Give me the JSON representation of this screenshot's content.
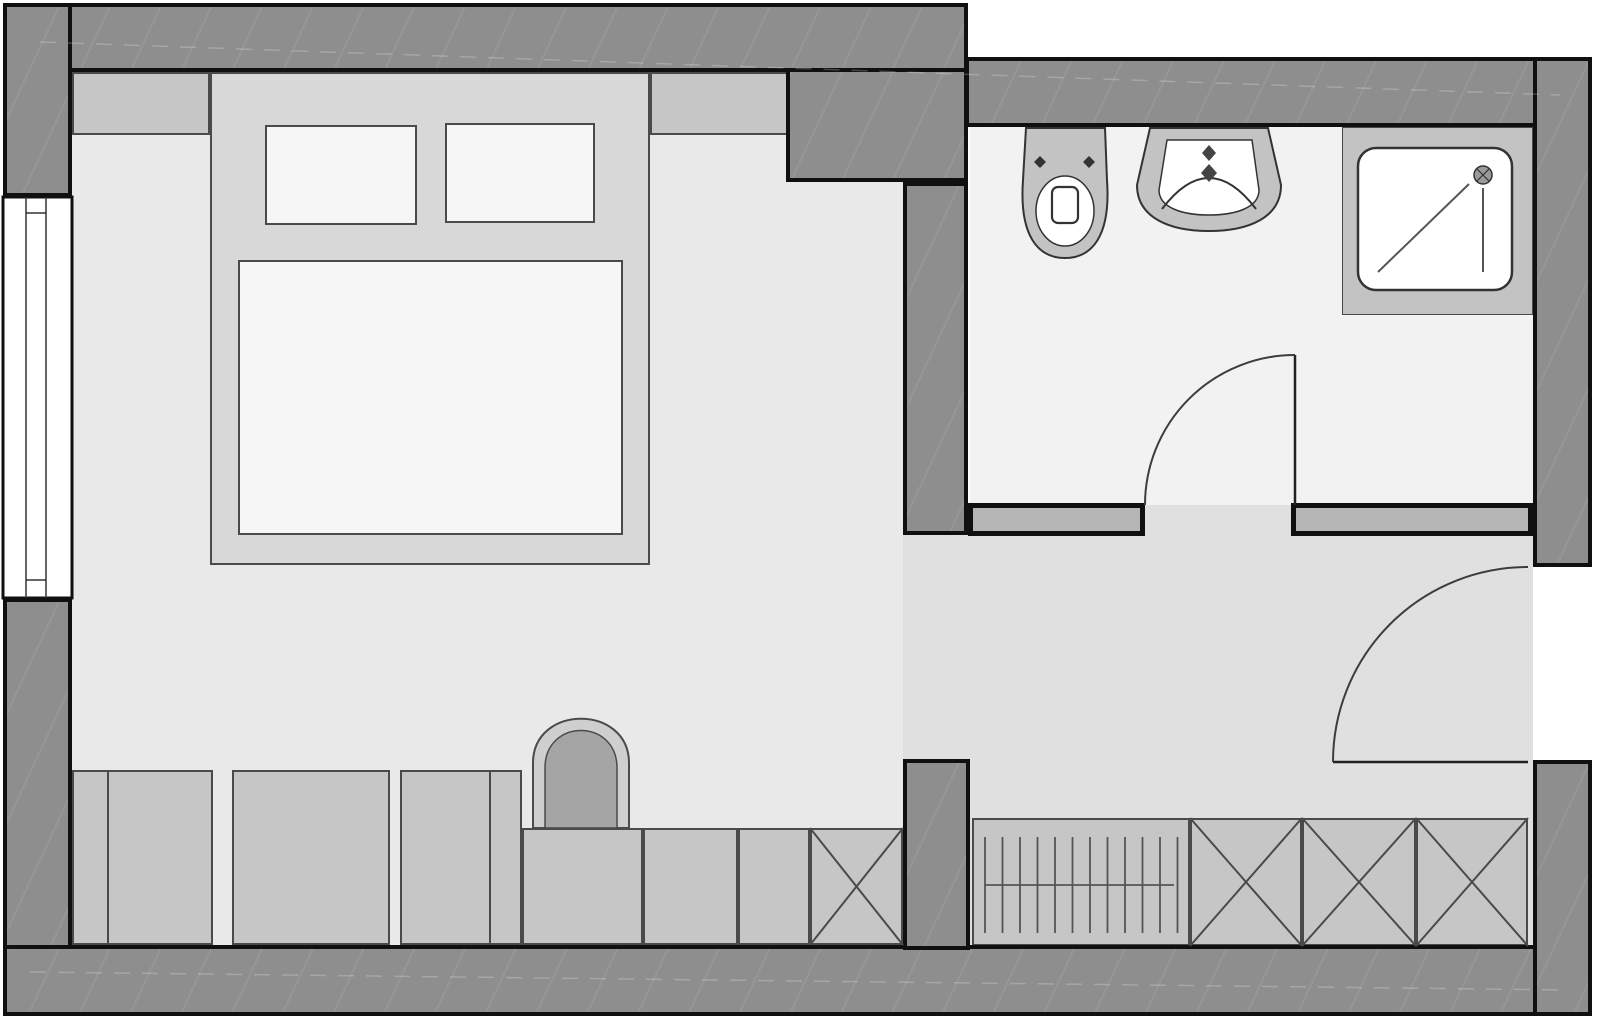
{
  "title": "hotel-room-floor-plan",
  "canvas": {
    "width": 1600,
    "height": 1021,
    "background": "#ffffff"
  },
  "palette": {
    "wall_dark": "#8e8e8e",
    "wall_light": "#b5b5b5",
    "outline": "#101010",
    "floor_bedroom": "#e9e9e9",
    "floor_hall": "#e0e0e0",
    "floor_bath": "#f2f2f2",
    "furniture": "#c6c6c6",
    "bed_platform": "#d8d8d8",
    "textile": "#f6f6f6",
    "fixture": "#c3c3c3",
    "arch_ring": "#cfcfcf",
    "arch_fill": "#a5a5a5",
    "stroke": "#4a4a4a",
    "fixture_stroke": "#333333",
    "door_stroke": "#3d3d3d",
    "white": "#ffffff"
  },
  "rects": [
    {
      "name": "floor-bedroom",
      "x": 72,
      "y": 72,
      "w": 896,
      "h": 873,
      "fill": "floor_bedroom"
    },
    {
      "name": "floor-hallway",
      "x": 903,
      "y": 505,
      "w": 630,
      "h": 440,
      "fill": "floor_hall"
    },
    {
      "name": "floor-bathroom",
      "x": 970,
      "y": 127,
      "w": 563,
      "h": 378,
      "fill": "floor_bath"
    },
    {
      "name": "headboard-shelf-left",
      "x": 72,
      "y": 72,
      "w": 138,
      "h": 63,
      "fill": "furniture",
      "stroke": "stroke",
      "bw": 2
    },
    {
      "name": "headboard-shelf-right",
      "x": 650,
      "y": 72,
      "w": 140,
      "h": 63,
      "fill": "furniture",
      "stroke": "stroke",
      "bw": 2
    },
    {
      "name": "bed-platform",
      "x": 210,
      "y": 72,
      "w": 440,
      "h": 493,
      "fill": "bed_platform",
      "stroke": "stroke",
      "bw": 2
    },
    {
      "name": "bed-pillow-left",
      "x": 265,
      "y": 125,
      "w": 152,
      "h": 100,
      "fill": "textile",
      "stroke": "stroke",
      "bw": 2
    },
    {
      "name": "bed-pillow-right",
      "x": 445,
      "y": 123,
      "w": 150,
      "h": 100,
      "fill": "textile",
      "stroke": "stroke",
      "bw": 2
    },
    {
      "name": "bed-mattress",
      "x": 238,
      "y": 260,
      "w": 385,
      "h": 275,
      "fill": "textile",
      "stroke": "stroke",
      "bw": 2
    },
    {
      "name": "dresser-unit-a",
      "x": 72,
      "y": 770,
      "w": 141,
      "h": 175,
      "fill": "furniture",
      "stroke": "stroke",
      "bw": 2
    },
    {
      "name": "dresser-unit-b",
      "x": 232,
      "y": 770,
      "w": 158,
      "h": 175,
      "fill": "furniture",
      "stroke": "stroke",
      "bw": 2
    },
    {
      "name": "dresser-unit-c",
      "x": 400,
      "y": 770,
      "w": 122,
      "h": 175,
      "fill": "furniture",
      "stroke": "stroke",
      "bw": 2
    },
    {
      "name": "lowboard-unit-d",
      "x": 522,
      "y": 828,
      "w": 121,
      "h": 117,
      "fill": "furniture",
      "stroke": "stroke",
      "bw": 2
    },
    {
      "name": "lowboard-unit-e",
      "x": 643,
      "y": 828,
      "w": 95,
      "h": 117,
      "fill": "furniture",
      "stroke": "stroke",
      "bw": 2
    },
    {
      "name": "lowboard-unit-f",
      "x": 738,
      "y": 828,
      "w": 72,
      "h": 117,
      "fill": "furniture",
      "stroke": "stroke",
      "bw": 2
    },
    {
      "name": "closet-crossed-bedroom",
      "x": 810,
      "y": 828,
      "w": 93,
      "h": 117,
      "fill": "furniture",
      "stroke": "stroke",
      "bw": 2
    },
    {
      "name": "wardrobe-rail-unit",
      "x": 972,
      "y": 818,
      "w": 218,
      "h": 128,
      "fill": "furniture",
      "stroke": "stroke",
      "bw": 2
    },
    {
      "name": "wardrobe-crossed-1",
      "x": 1190,
      "y": 818,
      "w": 112,
      "h": 128,
      "fill": "furniture",
      "stroke": "stroke",
      "bw": 2
    },
    {
      "name": "wardrobe-crossed-2",
      "x": 1302,
      "y": 818,
      "w": 114,
      "h": 128,
      "fill": "furniture",
      "stroke": "stroke",
      "bw": 2
    },
    {
      "name": "wardrobe-crossed-3",
      "x": 1416,
      "y": 818,
      "w": 112,
      "h": 128,
      "fill": "furniture",
      "stroke": "stroke",
      "bw": 2
    },
    {
      "name": "shower-platform",
      "x": 1342,
      "y": 127,
      "w": 191,
      "h": 188,
      "fill": "fixture",
      "stroke": "stroke",
      "bw": 1
    },
    {
      "name": "wall-bath-south-left",
      "x": 968,
      "y": 503,
      "w": 177,
      "h": 33,
      "fill": "wall_light",
      "stroke": "outline",
      "bw": 5
    },
    {
      "name": "wall-bath-south-right",
      "x": 1291,
      "y": 503,
      "w": 242,
      "h": 33,
      "fill": "wall_light",
      "stroke": "outline",
      "bw": 5
    },
    {
      "name": "wall-top-left-section",
      "x": 3,
      "y": 3,
      "w": 965,
      "h": 69,
      "fill": "wall_dark",
      "stroke": "outline",
      "bw": 4,
      "tex": true
    },
    {
      "name": "wall-top-right-section",
      "x": 965,
      "y": 57,
      "w": 627,
      "h": 70,
      "fill": "wall_dark",
      "stroke": "outline",
      "bw": 4,
      "tex": true
    },
    {
      "name": "wall-corner-duct",
      "x": 786,
      "y": 68,
      "w": 182,
      "h": 114,
      "fill": "wall_dark",
      "stroke": "outline",
      "bw": 4,
      "tex": true
    },
    {
      "name": "wall-left-above-window",
      "x": 3,
      "y": 3,
      "w": 69,
      "h": 194,
      "fill": "wall_dark",
      "stroke": "outline",
      "bw": 4,
      "tex": true
    },
    {
      "name": "wall-left-below-window",
      "x": 3,
      "y": 598,
      "w": 69,
      "h": 418,
      "fill": "wall_dark",
      "stroke": "outline",
      "bw": 4,
      "tex": true
    },
    {
      "name": "wall-bottom",
      "x": 3,
      "y": 945,
      "w": 1589,
      "h": 71,
      "fill": "wall_dark",
      "stroke": "outline",
      "bw": 4,
      "tex": true
    },
    {
      "name": "wall-right-upper",
      "x": 1533,
      "y": 57,
      "w": 59,
      "h": 510,
      "fill": "wall_dark",
      "stroke": "outline",
      "bw": 4,
      "tex": true
    },
    {
      "name": "wall-right-lower",
      "x": 1533,
      "y": 760,
      "w": 59,
      "h": 256,
      "fill": "wall_dark",
      "stroke": "outline",
      "bw": 4,
      "tex": true
    },
    {
      "name": "wall-bathroom-west",
      "x": 903,
      "y": 182,
      "w": 65,
      "h": 353,
      "fill": "wall_dark",
      "stroke": "outline",
      "bw": 4,
      "tex": true
    },
    {
      "name": "wall-stub-hall",
      "x": 903,
      "y": 759,
      "w": 67,
      "h": 191,
      "fill": "wall_dark",
      "stroke": "outline",
      "bw": 4,
      "tex": true
    }
  ],
  "vector": [
    {
      "tag": "rect",
      "name": "window-frame",
      "x": 3,
      "y": 197,
      "w": 69,
      "h": 401,
      "fill": "#ffffff",
      "stroke": "#101010",
      "sw": 3
    },
    {
      "tag": "line",
      "name": "window-mullion-outer",
      "x1": 26,
      "y1": 197,
      "x2": 26,
      "y2": 598,
      "stroke": "#333333",
      "sw": 1.5
    },
    {
      "tag": "line",
      "name": "window-mullion-inner",
      "x1": 46,
      "y1": 197,
      "x2": 46,
      "y2": 598,
      "stroke": "#333333",
      "sw": 1.5
    },
    {
      "tag": "line",
      "name": "window-divider-top",
      "x1": 26,
      "y1": 213,
      "x2": 46,
      "y2": 213,
      "stroke": "#333333",
      "sw": 1.5
    },
    {
      "tag": "line",
      "name": "window-divider-bottom",
      "x1": 26,
      "y1": 580,
      "x2": 46,
      "y2": 580,
      "stroke": "#333333",
      "sw": 1.5
    },
    {
      "tag": "line",
      "name": "dresser-a-divider",
      "x1": 108,
      "y1": 770,
      "x2": 108,
      "y2": 945,
      "stroke": "#4a4a4a",
      "sw": 2
    },
    {
      "tag": "line",
      "name": "dresser-c-divider",
      "x1": 490,
      "y1": 770,
      "x2": 490,
      "y2": 945,
      "stroke": "#4a4a4a",
      "sw": 2
    },
    {
      "tag": "path",
      "name": "armchair-outer",
      "d": "M533,828 V763 C533,704 629,704 629,763 V828 Z",
      "fill": "#cfcfcf",
      "stroke": "#4a4a4a",
      "sw": 2
    },
    {
      "tag": "path",
      "name": "armchair-inner",
      "d": "M545,828 V768 C545,718 617,718 617,768 V828 Z",
      "fill": "#a5a5a5",
      "stroke": "#4a4a4a",
      "sw": 1.5
    },
    {
      "tag": "cross",
      "name": "closet-bedroom-x",
      "x": 810,
      "y": 828,
      "w": 93,
      "h": 117,
      "stroke": "#4a4a4a",
      "sw": 2
    },
    {
      "tag": "cross",
      "name": "wardrobe-x1",
      "x": 1190,
      "y": 818,
      "w": 112,
      "h": 128,
      "stroke": "#4a4a4a",
      "sw": 2
    },
    {
      "tag": "cross",
      "name": "wardrobe-x2",
      "x": 1302,
      "y": 818,
      "w": 114,
      "h": 128,
      "stroke": "#4a4a4a",
      "sw": 2
    },
    {
      "tag": "cross",
      "name": "wardrobe-x3",
      "x": 1416,
      "y": 818,
      "w": 112,
      "h": 128,
      "stroke": "#4a4a4a",
      "sw": 2
    },
    {
      "tag": "hatch",
      "name": "wardrobe-rail-hangers",
      "x0": 985,
      "step": 17.5,
      "count": 12,
      "y1": 837,
      "y2": 933,
      "stroke": "#555555",
      "sw": 1.8
    },
    {
      "tag": "line",
      "name": "wardrobe-rail-bar",
      "x1": 985,
      "y1": 885,
      "x2": 1174,
      "y2": 885,
      "stroke": "#555555",
      "sw": 1.8
    },
    {
      "tag": "path",
      "name": "toilet-body",
      "d": "M1026,128 L1105,128 L1107,180 C1111,236 1092,258 1065,258 C1038,258 1019,236 1023,180 Z",
      "fill": "#c3c3c3",
      "stroke": "#333333",
      "sw": 2
    },
    {
      "tag": "ellipse",
      "name": "toilet-bowl",
      "cx": 1065,
      "cy": 211,
      "rx": 29,
      "ry": 35,
      "fill": "#ffffff",
      "stroke": "#333333",
      "sw": 1.5
    },
    {
      "tag": "rect",
      "name": "toilet-flush",
      "x": 1052,
      "y": 187,
      "w": 26,
      "h": 36,
      "rx": 6,
      "fill": "#ffffff",
      "stroke": "#333333",
      "sw": 2.2
    },
    {
      "tag": "path",
      "name": "toilet-bolt-left",
      "d": "M1040,156 l6,6 l-6,6 l-6,-6 Z",
      "fill": "#333333",
      "stroke": "none",
      "sw": 0
    },
    {
      "tag": "path",
      "name": "toilet-bolt-right",
      "d": "M1089,156 l6,6 l-6,6 l-6,-6 Z",
      "fill": "#333333",
      "stroke": "none",
      "sw": 0
    },
    {
      "tag": "path",
      "name": "sink-body",
      "d": "M1150,128 L1268,128 L1281,185 C1281,218 1248,231 1209,231 C1170,231 1137,218 1137,185 Z",
      "fill": "#c3c3c3",
      "stroke": "#333333",
      "sw": 2
    },
    {
      "tag": "path",
      "name": "sink-basin",
      "d": "M1167,140 L1252,140 L1259,190 C1259,208 1235,215 1209,215 C1183,215 1159,208 1159,190 Z",
      "fill": "#ffffff",
      "stroke": "#333333",
      "sw": 1.5
    },
    {
      "tag": "path",
      "name": "sink-bowl-arc",
      "d": "M1162,209 Q1209,147 1256,209",
      "fill": "none",
      "stroke": "#333333",
      "sw": 2
    },
    {
      "tag": "path",
      "name": "sink-faucet-upper",
      "d": "M1209,145 l7,8 l-7,8 l-7,-8 Z",
      "fill": "#444444",
      "stroke": "none",
      "sw": 0
    },
    {
      "tag": "path",
      "name": "sink-faucet-lower",
      "d": "M1209,164 l8,9 l-8,9 l-8,-9 Z",
      "fill": "#444444",
      "stroke": "none",
      "sw": 0
    },
    {
      "tag": "rect",
      "name": "shower-tray",
      "x": 1358,
      "y": 148,
      "w": 154,
      "h": 142,
      "rx": 18,
      "fill": "#ffffff",
      "stroke": "#333333",
      "sw": 2.5
    },
    {
      "tag": "line",
      "name": "shower-slope-diagonal",
      "x1": 1378,
      "y1": 272,
      "x2": 1469,
      "y2": 184,
      "stroke": "#555555",
      "sw": 2
    },
    {
      "tag": "line",
      "name": "shower-slope-vertical",
      "x1": 1483,
      "y1": 188,
      "x2": 1483,
      "y2": 272,
      "stroke": "#555555",
      "sw": 2
    },
    {
      "tag": "circle",
      "name": "shower-drain",
      "cx": 1483,
      "cy": 175,
      "r": 9,
      "fill": "#9a9a9a",
      "stroke": "#333333",
      "sw": 1.5
    },
    {
      "tag": "line",
      "name": "shower-drain-cross-1",
      "x1": 1477,
      "y1": 169,
      "x2": 1489,
      "y2": 181,
      "stroke": "#333333",
      "sw": 1.2
    },
    {
      "tag": "line",
      "name": "shower-drain-cross-2",
      "x1": 1489,
      "y1": 169,
      "x2": 1477,
      "y2": 181,
      "stroke": "#333333",
      "sw": 1.2
    },
    {
      "tag": "line",
      "name": "bathroom-door-leaf",
      "x1": 1295,
      "y1": 355,
      "x2": 1295,
      "y2": 505,
      "stroke": "#222222",
      "sw": 2.5
    },
    {
      "tag": "path",
      "name": "bathroom-door-swing",
      "d": "M1145,505 A150,150 0 0 1 1295,355",
      "fill": "none",
      "stroke": "#3d3d3d",
      "sw": 2
    },
    {
      "tag": "line",
      "name": "entry-door-leaf",
      "x1": 1333,
      "y1": 762,
      "x2": 1528,
      "y2": 762,
      "stroke": "#222222",
      "sw": 2.5
    },
    {
      "tag": "path",
      "name": "entry-door-swing",
      "d": "M1333,762 A195,195 0 0 1 1528,567",
      "fill": "none",
      "stroke": "#3d3d3d",
      "sw": 2
    },
    {
      "tag": "line",
      "name": "wall-texture-top",
      "x1": 40,
      "y1": 42,
      "x2": 1560,
      "y2": 95,
      "stroke": "rgba(255,255,255,0.22)",
      "sw": 1.5,
      "dash": "16 12"
    },
    {
      "tag": "line",
      "name": "wall-texture-bottom",
      "x1": 30,
      "y1": 972,
      "x2": 1570,
      "y2": 990,
      "stroke": "rgba(255,255,255,0.22)",
      "sw": 1.5,
      "dash": "16 12"
    }
  ]
}
